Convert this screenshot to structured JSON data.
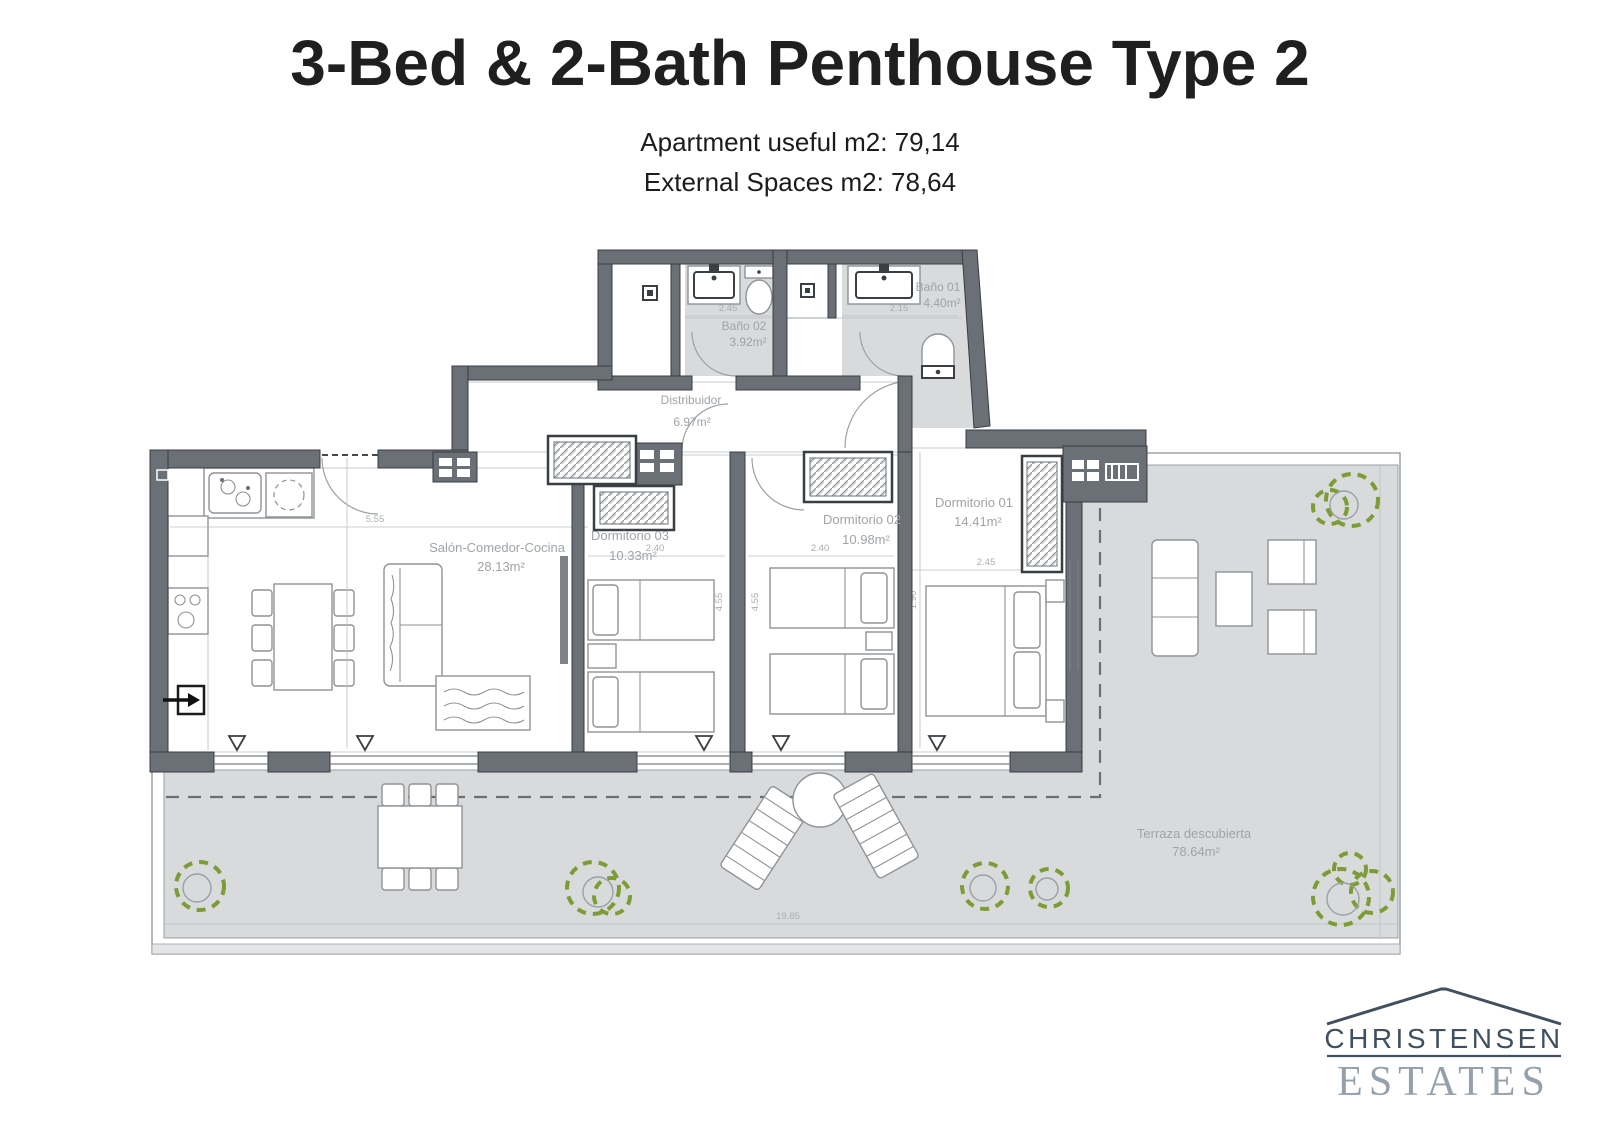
{
  "header": {
    "title": "3-Bed & 2-Bath Penthouse Type 2",
    "subtitle1": "Apartment useful m2: 79,14",
    "subtitle2": "External Spaces m2: 78,64"
  },
  "floorplan": {
    "rooms": {
      "bano01": {
        "name": "Baño 01",
        "area": "4.40m²"
      },
      "bano02": {
        "name": "Baño 02",
        "area": "3.92m²"
      },
      "distribuidor": {
        "name": "Distribuidor",
        "area": "6.97m²"
      },
      "salon": {
        "name": "Salón-Comedor-Cocina",
        "area": "28.13m²"
      },
      "dorm03": {
        "name": "Dormitorio 03",
        "area": "10.33m²"
      },
      "dorm02": {
        "name": "Dormitorio 02",
        "area": "10.98m²"
      },
      "dorm01": {
        "name": "Dormitorio 01",
        "area": "14.41m²"
      },
      "terraza": {
        "name": "Terraza descubierta",
        "area": "78.64m²"
      }
    },
    "dimensions": {
      "bano02_width": "2.45",
      "bano01_width": "2.15",
      "salon_width": "5.55",
      "dorm03_width": "2.40",
      "dorm02_width": "2.40",
      "dorm01_width": "2.45",
      "dorm01_depth": "1.90",
      "dorm03_depth": "4.55",
      "dorm02_depth": "4.55",
      "terrace_width": "19.85"
    },
    "colors": {
      "wall": "#6a7076",
      "terrace_floor": "#d8dadb",
      "plant_green": "#7d9c35",
      "label_gray": "#9fa4a8"
    }
  },
  "logo": {
    "line1": "CHRISTENSEN",
    "line2": "ESTATES"
  }
}
